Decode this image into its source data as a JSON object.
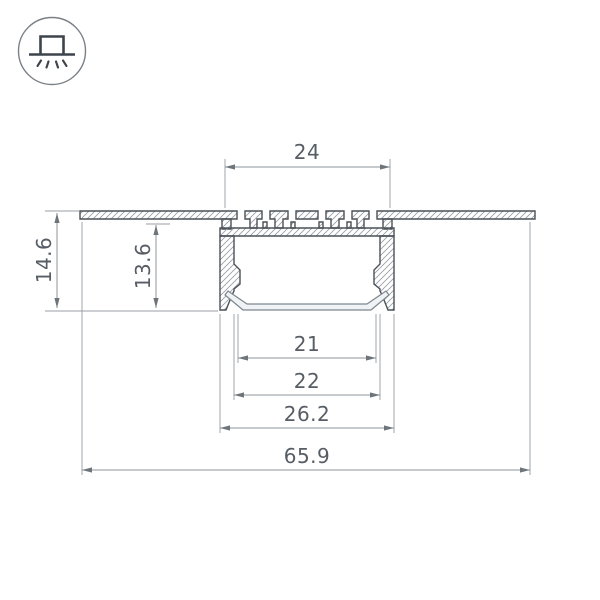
{
  "meta": {
    "canvas_width": 600,
    "canvas_height": 600,
    "background": "#ffffff"
  },
  "icon": {
    "name": "recessed-mount",
    "description": "circle badge with recessed profile above surface line and light rays below"
  },
  "drawing": {
    "type": "technical-cross-section",
    "subject": "recessed aluminum LED profile cross-section with diffuser",
    "dimensions": [
      {
        "id": "top-slot-width",
        "value": "24",
        "orientation": "horizontal"
      },
      {
        "id": "overall-height",
        "value": "14.6",
        "orientation": "vertical"
      },
      {
        "id": "inner-height",
        "value": "13.6",
        "orientation": "vertical"
      },
      {
        "id": "diffuser-flat-width",
        "value": "21",
        "orientation": "horizontal"
      },
      {
        "id": "inner-width",
        "value": "22",
        "orientation": "horizontal"
      },
      {
        "id": "body-width",
        "value": "26.2",
        "orientation": "horizontal"
      },
      {
        "id": "flange-width",
        "value": "65.9",
        "orientation": "horizontal"
      }
    ],
    "colors": {
      "outline": "#4a5157",
      "hatch": "#9ba1a7",
      "dimension_line": "#8d949a",
      "extension_line": "#989ea4",
      "arrow": "#6d747a",
      "text": "#575d64",
      "diffuser_fill": "#f0f3f5",
      "icon_glyph": "#3d444b"
    }
  }
}
